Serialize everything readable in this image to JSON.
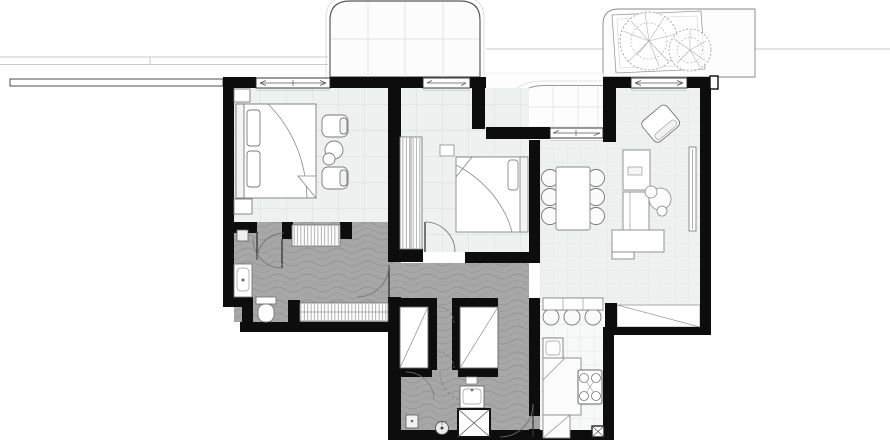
{
  "document": {
    "type": "architectural-floor-plan",
    "visible_text": "none"
  },
  "colors": {
    "white": "#ffffff",
    "wall": "#0d0d0d",
    "floor": "#eff1f1",
    "floor_grid": "#d9dcdc",
    "kitchen_floor": "#f7f8f8",
    "corridor": "#a7a7a7",
    "corridor_wave": "#8d8d8d",
    "furniture_stroke": "#7a7a7a",
    "light_outline": "#c9c9c9",
    "balcony_fill": "#fcfcfc",
    "tree_stroke": "#9a9a9a"
  },
  "elements": {
    "outdoor": [
      "balcony-canopy",
      "loggia-recess",
      "terrace-planter",
      "tree-large-icon",
      "tree-small-icon",
      "party-wall-line"
    ],
    "rooms": [
      "bedroom-1",
      "bedroom-2",
      "living-dining",
      "kitchen",
      "corridor-hall",
      "wc",
      "bathroom-laundry"
    ],
    "fixtures": [
      "master-bed",
      "armchair-pair",
      "side-table",
      "entry-bench",
      "hall-wardrobe",
      "built-in-wardrobe",
      "wc-vanity",
      "wc-toilet",
      "double-bed-2",
      "dining-table",
      "dining-chairs-6",
      "lounge-armchair",
      "desk",
      "cabinet",
      "plant",
      "sideboard",
      "radiator",
      "bar-counter",
      "bar-stools-3",
      "kitchen-sink",
      "kitchen-counter",
      "gas-stove",
      "shower",
      "bath-sink",
      "floor-drain",
      "closet-shafts",
      "window-arrows"
    ]
  },
  "counts": {
    "windows": 4,
    "door-swings": 8,
    "dining_chairs": 6,
    "bar_stools": 3,
    "trees": 2
  }
}
